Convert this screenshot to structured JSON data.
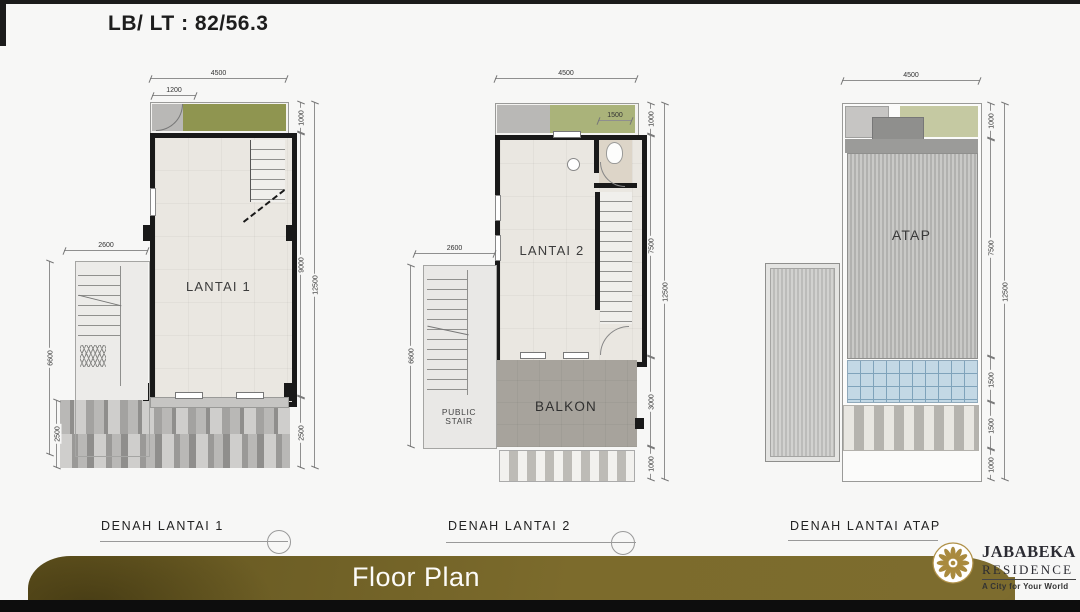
{
  "header": {
    "lb_lt_label": "LB/ LT : 82/56.3"
  },
  "plans": [
    {
      "room_label": "LANTAI 1",
      "caption": "DENAH LANTAI 1",
      "dims": {
        "top": "4500",
        "top_sub": "1200",
        "left_top": "2600",
        "left_side": "6600",
        "left_bottom": "2500",
        "right_total": "12500",
        "right_segments": [
          "1000",
          "9000",
          "2500"
        ]
      }
    },
    {
      "room_label": "LANTAI 2",
      "balcony_label": "BALKON",
      "public_stair_line1": "PUBLIC",
      "public_stair_line2": "STAIR",
      "caption": "DENAH LANTAI 2",
      "dims": {
        "top": "4500",
        "garden": "1500",
        "left_top": "2600",
        "left_side": "6600",
        "right_total": "12500",
        "right_segments": [
          "1000",
          "7500",
          "3000",
          "1000"
        ]
      }
    },
    {
      "room_label": "ATAP",
      "caption": "DENAH LANTAI ATAP",
      "dims": {
        "top": "4500",
        "right_total": "12500",
        "right_segments": [
          "1000",
          "7500",
          "1500",
          "1500",
          "1000"
        ]
      }
    }
  ],
  "footer": {
    "title": "Floor Plan"
  },
  "logo": {
    "brand": "JABABEKA",
    "division": "RESIDENCE",
    "tagline": "A City for Your World"
  },
  "colors": {
    "ribbon_gold": "#7c6b2c",
    "ribbon_dark": "#5e5120",
    "logo_gold": "#a98a3e",
    "wall_black": "#191919",
    "garden_green_1": "#8f9550",
    "garden_green_2": "#aab37a",
    "garden_green_3": "#c5c9a2",
    "glass_blue": "#c3d8e5",
    "balcony_gray": "#a7a39c"
  }
}
